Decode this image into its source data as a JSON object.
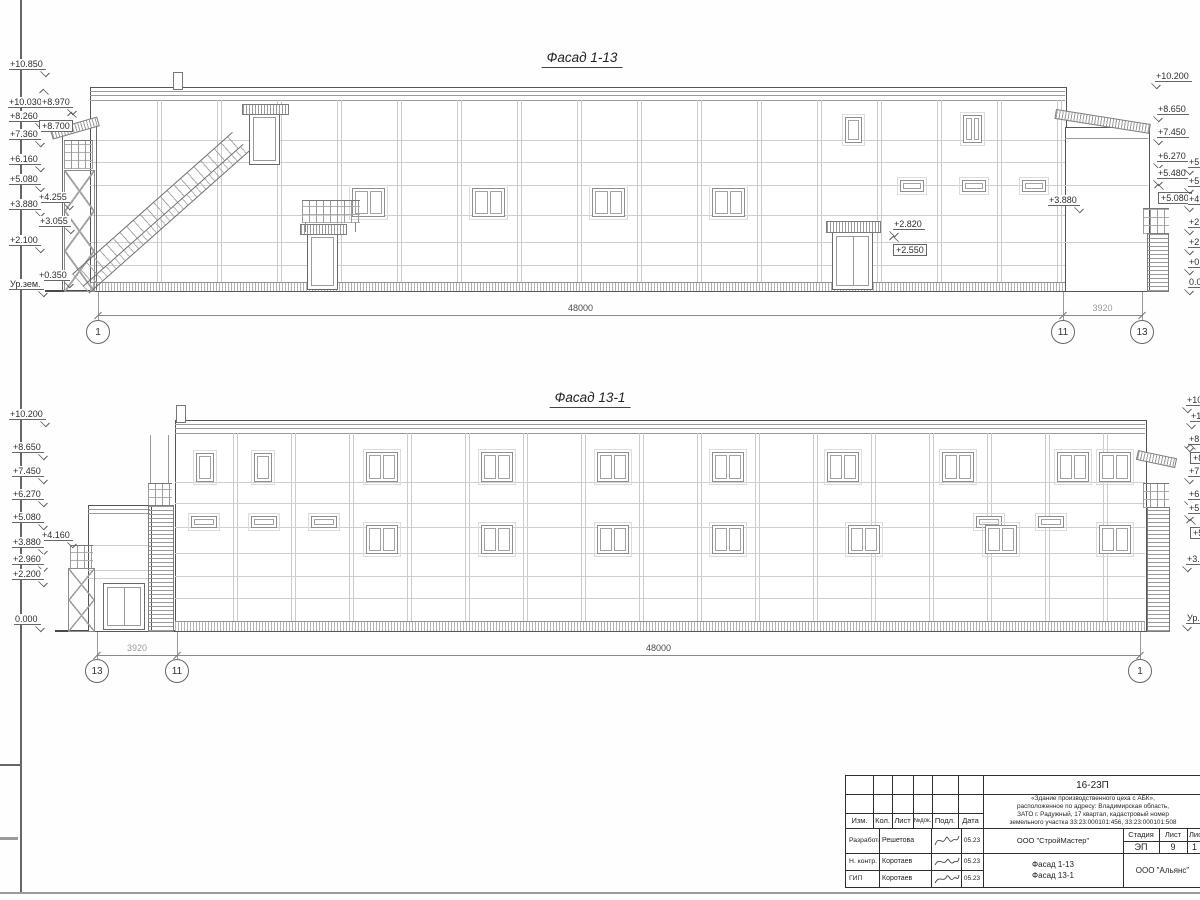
{
  "facade1": {
    "title": "Фасад 1-13",
    "marks": [
      {
        "t": "+10.850",
        "x": 9,
        "y": 59,
        "d": "dn"
      },
      {
        "t": "+10.030",
        "x": 8,
        "y": 97,
        "d": "up"
      },
      {
        "t": "+8.970",
        "x": 41,
        "y": 97,
        "d": "dn"
      },
      {
        "t": "+8.260",
        "x": 9,
        "y": 111,
        "d": "dn"
      },
      {
        "t": "+8.700",
        "x": 39,
        "y": 120,
        "d": "up",
        "box": true
      },
      {
        "t": "+7.360",
        "x": 9,
        "y": 129,
        "d": "dn"
      },
      {
        "t": "+6.160",
        "x": 9,
        "y": 154,
        "d": "dn"
      },
      {
        "t": "+5.080",
        "x": 9,
        "y": 174,
        "d": "dn"
      },
      {
        "t": "+4.255",
        "x": 38,
        "y": 192,
        "d": "dn"
      },
      {
        "t": "+3.880",
        "x": 9,
        "y": 199,
        "d": "dn"
      },
      {
        "t": "+3.055",
        "x": 39,
        "y": 216,
        "d": "dn"
      },
      {
        "t": "+2.100",
        "x": 9,
        "y": 235,
        "d": "dn"
      },
      {
        "t": "+0.350",
        "x": 38,
        "y": 270,
        "d": "dn"
      },
      {
        "t": "Ур.зем.",
        "x": 9,
        "y": 279,
        "d": "dn"
      },
      {
        "t": "+10.200",
        "x": 1155,
        "y": 71,
        "d": "dn",
        "r": true
      },
      {
        "t": "+8.650",
        "x": 1157,
        "y": 104,
        "d": "dn",
        "r": true
      },
      {
        "t": "+7.450",
        "x": 1157,
        "y": 127,
        "d": "dn",
        "r": true
      },
      {
        "t": "+6.270",
        "x": 1157,
        "y": 151,
        "d": "dn",
        "r": true
      },
      {
        "t": "+5.480",
        "x": 1157,
        "y": 168,
        "d": "dn",
        "r": true
      },
      {
        "t": "+5.080",
        "x": 1158,
        "y": 192,
        "d": "up",
        "box": true,
        "r": true
      },
      {
        "t": "+5.",
        "x": 1188,
        "y": 157,
        "d": "dn",
        "r": true
      },
      {
        "t": "+5.",
        "x": 1188,
        "y": 176,
        "d": "dn",
        "r": true
      },
      {
        "t": "+4.",
        "x": 1188,
        "y": 194,
        "d": "dn",
        "r": true
      },
      {
        "t": "+2.",
        "x": 1188,
        "y": 217,
        "d": "dn",
        "r": true
      },
      {
        "t": "+2.",
        "x": 1188,
        "y": 237,
        "d": "dn",
        "r": true
      },
      {
        "t": "+0.",
        "x": 1188,
        "y": 257,
        "d": "dn",
        "r": true
      },
      {
        "t": "0.0",
        "x": 1188,
        "y": 277,
        "d": "dn",
        "r": true
      },
      {
        "t": "+3.880",
        "x": 1048,
        "y": 195,
        "d": "dn"
      },
      {
        "t": "+2.820",
        "x": 893,
        "y": 219,
        "d": "dn",
        "r": true
      },
      {
        "t": "+2.550",
        "x": 893,
        "y": 244,
        "d": "up",
        "box": true,
        "r": true
      }
    ],
    "axes": [
      {
        "label": "1",
        "x": 98
      },
      {
        "label": "11",
        "x": 1063
      },
      {
        "label": "13",
        "x": 1142
      }
    ],
    "dims": [
      {
        "text": "48000",
        "x1": 98,
        "x2": 1063,
        "shade": "dark"
      },
      {
        "text": "3920",
        "x1": 1063,
        "x2": 1142,
        "shade": "light"
      }
    ],
    "dim_y": 315,
    "bub_y": 320,
    "lead_top": 292
  },
  "facade2": {
    "title": "Фасад 13-1",
    "marks": [
      {
        "t": "+10.200",
        "x": 9,
        "y": 409,
        "d": "dn"
      },
      {
        "t": "+8.650",
        "x": 12,
        "y": 442,
        "d": "dn"
      },
      {
        "t": "+7.450",
        "x": 12,
        "y": 466,
        "d": "dn"
      },
      {
        "t": "+6.270",
        "x": 12,
        "y": 489,
        "d": "dn"
      },
      {
        "t": "+5.080",
        "x": 12,
        "y": 512,
        "d": "dn"
      },
      {
        "t": "+4.160",
        "x": 41,
        "y": 530,
        "d": "dn"
      },
      {
        "t": "+3.880",
        "x": 12,
        "y": 537,
        "d": "dn"
      },
      {
        "t": "+2.960",
        "x": 12,
        "y": 554,
        "d": "dn"
      },
      {
        "t": "+2.200",
        "x": 12,
        "y": 569,
        "d": "dn"
      },
      {
        "t": "0.000",
        "x": 14,
        "y": 614,
        "d": "dn"
      },
      {
        "t": "+10.",
        "x": 1186,
        "y": 395,
        "d": "dn",
        "r": true
      },
      {
        "t": "+10.",
        "x": 1190,
        "y": 411,
        "d": "dn",
        "r": true
      },
      {
        "t": "+8.",
        "x": 1188,
        "y": 434,
        "d": "dn",
        "r": true
      },
      {
        "t": "+8.",
        "x": 1190,
        "y": 452,
        "d": "up",
        "box": true,
        "r": true
      },
      {
        "t": "+7.",
        "x": 1188,
        "y": 466,
        "d": "dn",
        "r": true
      },
      {
        "t": "+6.",
        "x": 1188,
        "y": 489,
        "d": "dn",
        "r": true
      },
      {
        "t": "+5.",
        "x": 1188,
        "y": 503,
        "d": "dn",
        "r": true
      },
      {
        "t": "+5.",
        "x": 1190,
        "y": 527,
        "d": "up",
        "box": true,
        "r": true
      },
      {
        "t": "+3.",
        "x": 1186,
        "y": 554,
        "d": "dn",
        "r": true
      },
      {
        "t": "Ур.",
        "x": 1186,
        "y": 613,
        "d": "dn",
        "r": true
      }
    ],
    "axes": [
      {
        "label": "13",
        "x": 97
      },
      {
        "label": "11",
        "x": 177
      },
      {
        "label": "1",
        "x": 1140
      }
    ],
    "dims": [
      {
        "text": "3920",
        "x1": 97,
        "x2": 177,
        "shade": "light"
      },
      {
        "text": "48000",
        "x1": 177,
        "x2": 1140,
        "shade": "dark"
      }
    ],
    "dim_y": 655,
    "bub_y": 659,
    "lead_top": 632
  },
  "titleblock": {
    "code": "16-23П",
    "description": "«Здание производственного цеха с АБК»,\nрасположенное по адресу: Владимирская область,\nЗАТО г. Радужный, 17 квартал, кадастровый номер\nземельного участка 33:23:000101:456, 33:23:000101:508",
    "org": "ООО \"СтройМастер\"",
    "firm": "ООО \"Альянс\"",
    "sheet_name": "Фасад 1-13\nФасад 13-1",
    "header_cols": [
      "Изм.",
      "Кол.",
      "Лист",
      "№док.",
      "Подл.",
      "Дата"
    ],
    "stage_label": "Стадия",
    "sheet_label": "Лист",
    "sheets_label": "Лис",
    "stage": "ЭП",
    "sheet": "9",
    "sheets": "1",
    "roles": [
      {
        "role": "Разработал",
        "name": "Решетова",
        "date": "05.23"
      },
      {
        "role": "Н. контр.",
        "name": "Коротаев",
        "date": "05.23"
      },
      {
        "role": "ГИП",
        "name": "Коротаев",
        "date": "05.23"
      }
    ]
  }
}
